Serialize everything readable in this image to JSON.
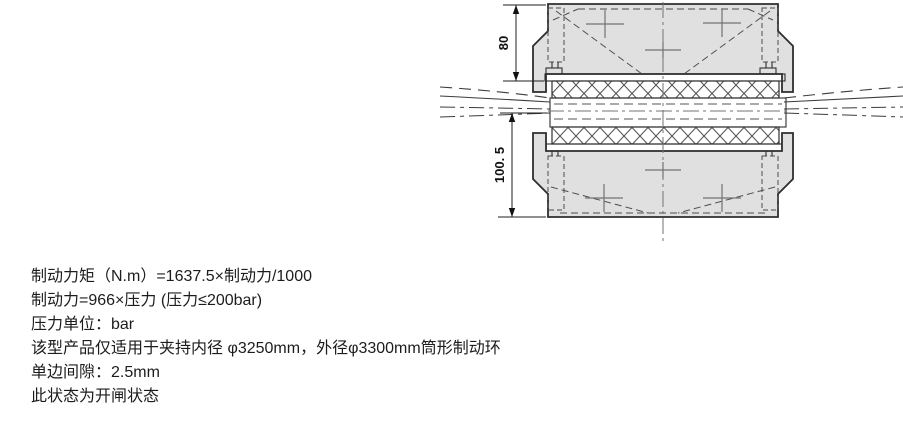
{
  "diagram": {
    "dimension_labels": {
      "upper": "80",
      "lower": "100. 5"
    }
  },
  "notes": {
    "lines": [
      "制动力矩（N.m）=1637.5×制动力/1000",
      "制动力=966×压力 (压力≤200bar)",
      "压力单位：bar",
      "该型产品仅适用于夹持内径 φ3250mm，外径φ3300mm筒形制动环",
      "单边间隙：2.5mm",
      "此状态为开闸状态"
    ]
  },
  "colors": {
    "background": "#ffffff",
    "housing_fill": "#e0e0e0",
    "pad_fill": "#f2f2f2",
    "plate_fill": "#e6e6e6",
    "ring_fill": "#e2e2e2",
    "outline": "#2e2e2e",
    "text": "#1c1c1c"
  }
}
